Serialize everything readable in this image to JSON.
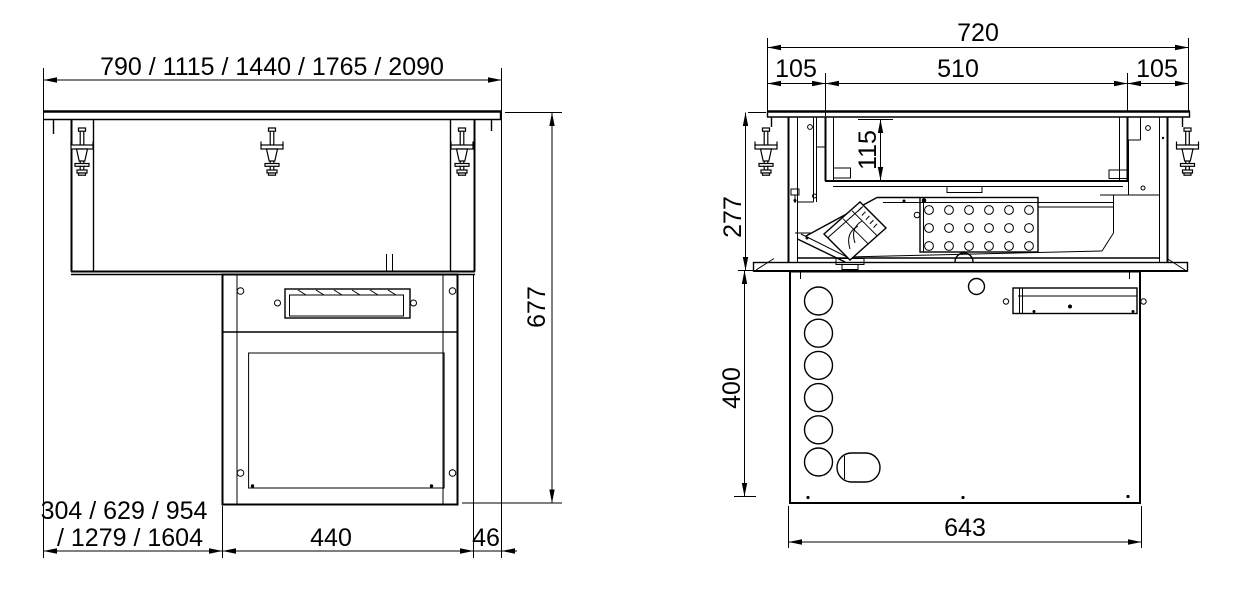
{
  "colors": {
    "line": "#000000",
    "background": "#ffffff"
  },
  "front_view": {
    "width_options": "790 / 1115 / 1440 / 1765 / 2090",
    "total_height": "677",
    "left_width_options_line1": "304 / 629 / 954",
    "left_width_options_line2": "/ 1279 / 1604",
    "vent_section_width": "440",
    "side_offset": "46"
  },
  "side_view": {
    "total_depth": "720",
    "front_flange": "105",
    "well_opening": "510",
    "rear_flange": "105",
    "well_depth": "115",
    "upper_section_height": "277",
    "lower_section_height": "400",
    "base_depth": "643"
  }
}
